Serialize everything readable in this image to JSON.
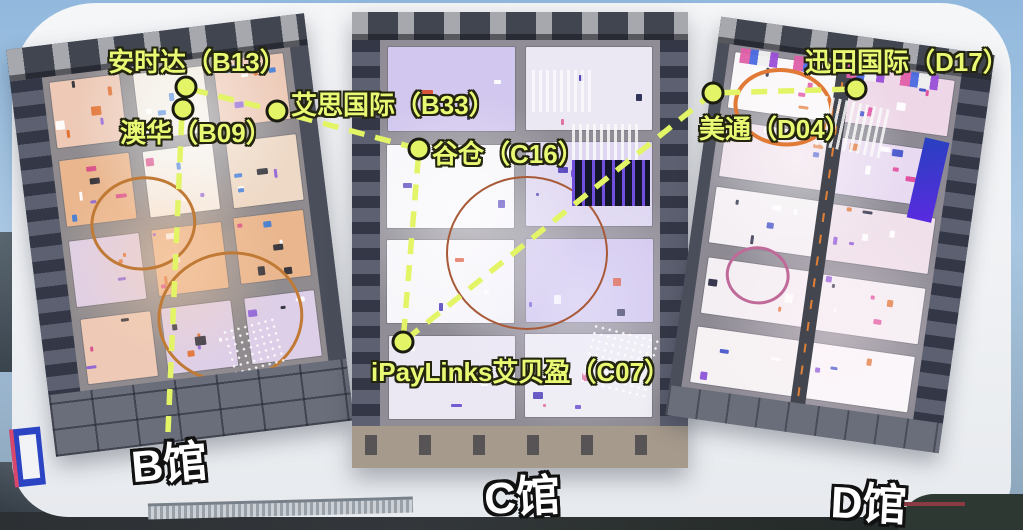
{
  "colors": {
    "route_line": "#e3f566",
    "marker_fill": "#e3f566",
    "marker_outline": "#1a1c10",
    "booth_label_text": "#e9f973",
    "booth_label_outline": "#23250f",
    "hall_label_text": "#ffffff",
    "hall_label_outline": "#111111",
    "sky": "#92b9dd",
    "platform": "#f1f3f5",
    "hall_frame": "#4e5361",
    "hall_floor_b": "#8f8b8e",
    "hall_floor_c": "#908d96",
    "hall_floor_d": "#8d8a94"
  },
  "markers": {
    "b13": {
      "label": "安时达（B13）"
    },
    "b09": {
      "label": "澳华（B09）"
    },
    "b33": {
      "label": "艾思国际（B33）"
    },
    "c16": {
      "label": "谷仓（C16）"
    },
    "c07": {
      "label": "iPayLinks艾贝盈（C07）"
    },
    "d04": {
      "label": "美通（D04）"
    },
    "d17": {
      "label": "迅田国际（D17）"
    }
  },
  "route_stops": [
    "B09",
    "B13",
    "B33",
    "C16",
    "C07",
    "D04",
    "D17"
  ],
  "halls": {
    "b": {
      "label": "B馆"
    },
    "c": {
      "label": "C馆"
    },
    "d": {
      "label": "D馆"
    }
  }
}
